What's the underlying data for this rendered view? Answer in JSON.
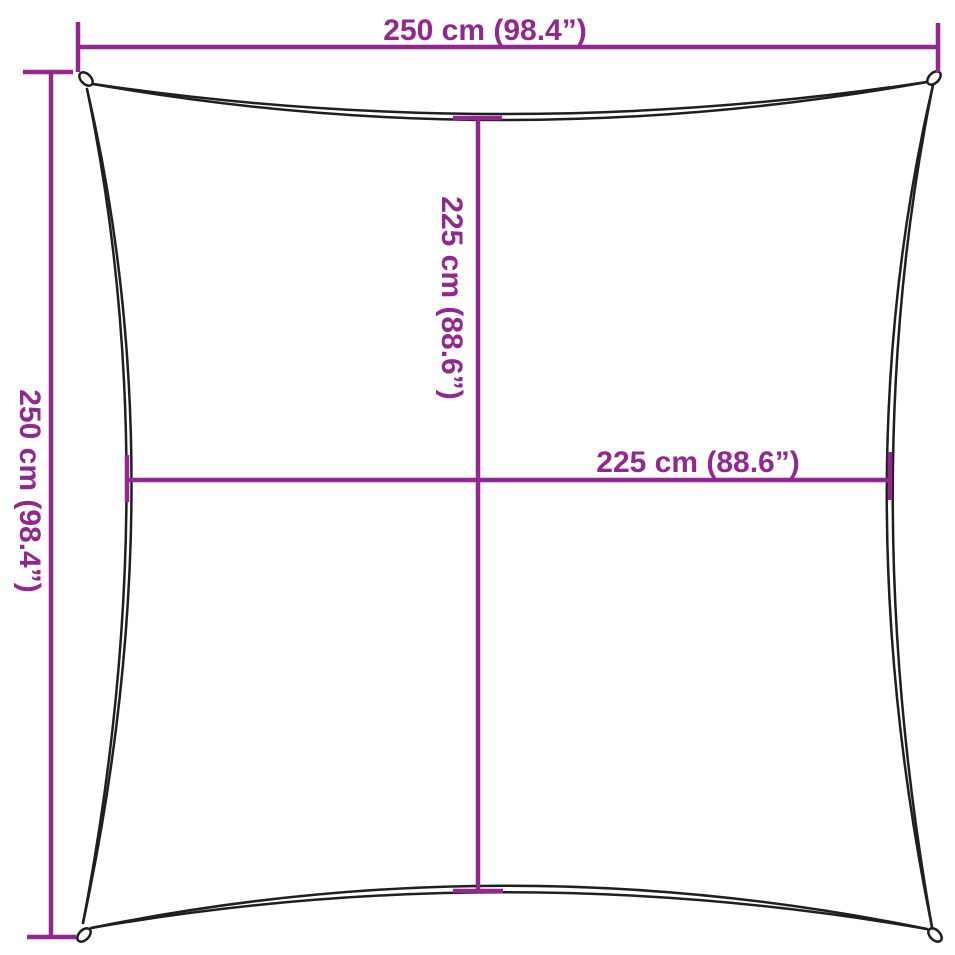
{
  "diagram": {
    "title": "Square shade sail dimension diagram",
    "background_color": "#ffffff",
    "dimension_color": "#92278F",
    "sail_outline_color": "#1f1f1f",
    "dimensions": {
      "outer_width": {
        "label": "250 cm (98.4”)"
      },
      "outer_height": {
        "label": "250 cm (98.4”)"
      },
      "inner_height": {
        "label": "225 cm (88.6”)"
      },
      "inner_width": {
        "label": "225 cm (88.6”)"
      }
    }
  }
}
